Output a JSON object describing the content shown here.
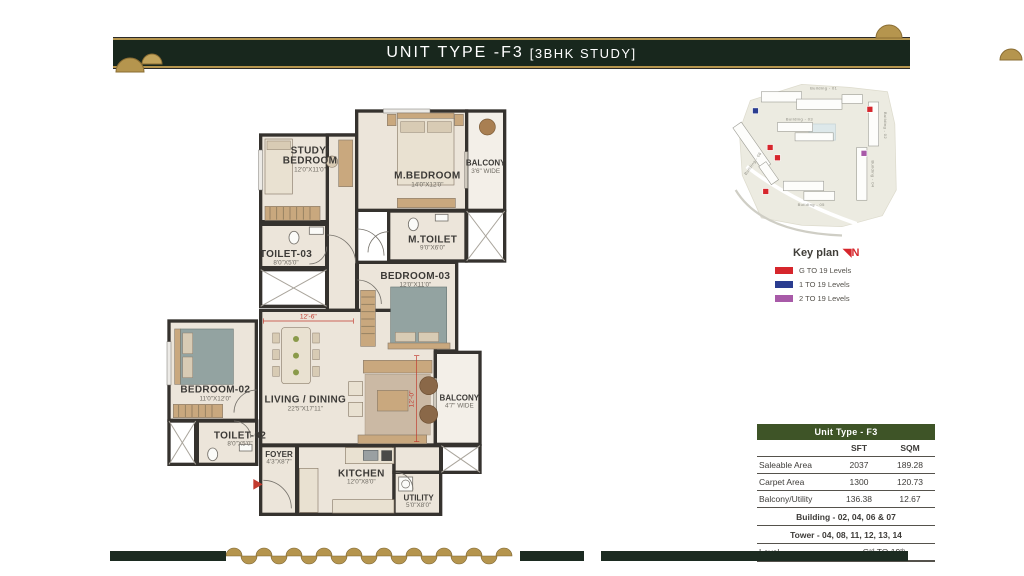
{
  "header": {
    "title_main": "UNIT TYPE -F3",
    "title_sub": "[3BHK STUDY]"
  },
  "floor_plan": {
    "rooms": [
      {
        "line1": "STUDY/",
        "line2": "BEDROOM",
        "dims": "12'0\"X11'0\""
      },
      {
        "name": "M.BEDROOM",
        "dims": "14'0\"X12'0\""
      },
      {
        "name": "BALCONY",
        "dims": "3'6\" WIDE"
      },
      {
        "name": "TOILET-03",
        "dims": "8'0\"X5'0\""
      },
      {
        "name": "M.TOILET",
        "dims": "9'0\"X6'0\""
      },
      {
        "name": "BEDROOM-03",
        "dims": "12'0\"X11'0\""
      },
      {
        "name": "BEDROOM-02",
        "dims": "11'0\"X12'0\""
      },
      {
        "name": "LIVING / DINING",
        "dims": "22'5\"X17'11\""
      },
      {
        "name": "TOILET-02",
        "dims": "8'0\"X5'0\""
      },
      {
        "name": "FOYER",
        "dims": "4'3\"X8'7\""
      },
      {
        "name": "KITCHEN",
        "dims": "12'0\"X8'0\""
      },
      {
        "name": "UTILITY",
        "dims": "5'0\"X8'0\""
      },
      {
        "name": "BALCONY",
        "dims": "4'7\" WIDE"
      }
    ],
    "dim_h": "12'-6\"",
    "dim_v": "12'-0\""
  },
  "key_plan": {
    "caption": "Key plan",
    "north_label": "N",
    "buildings": [
      "Building - 01",
      "Building - 02",
      "Building - 03",
      "Building - 04",
      "Building - 05",
      "Building - 06"
    ],
    "legend": [
      {
        "color": "#d6262c",
        "label": "G  TO 19 Levels"
      },
      {
        "color": "#2b3d90",
        "label": "1  TO 19 Levels"
      },
      {
        "color": "#a85aa8",
        "label": "2  TO 19 Levels"
      }
    ]
  },
  "table": {
    "title": "Unit Type - F3",
    "col_sft": "SFT",
    "col_sqm": "SQM",
    "rows": [
      {
        "label": "Saleable Area",
        "sft": "2037",
        "sqm": "189.28"
      },
      {
        "label": "Carpet Area",
        "sft": "1300",
        "sqm": "120.73"
      },
      {
        "label": "Balcony/Utility",
        "sft": "136.38",
        "sqm": "12.67"
      }
    ],
    "building_row": "Building - 02, 04, 06 & 07",
    "tower_row": "Tower - 04, 08, 11, 12, 13, 14",
    "level_label": "Level",
    "level_value": "Gʳᵈ TO 19ᵗʰ"
  },
  "colors": {
    "banner_green": "#18271d",
    "gold": "#b5954e",
    "table_green": "#3e5427",
    "marker_red": "#d6262c",
    "marker_blue": "#2b3d90",
    "marker_purple": "#a85aa8"
  }
}
